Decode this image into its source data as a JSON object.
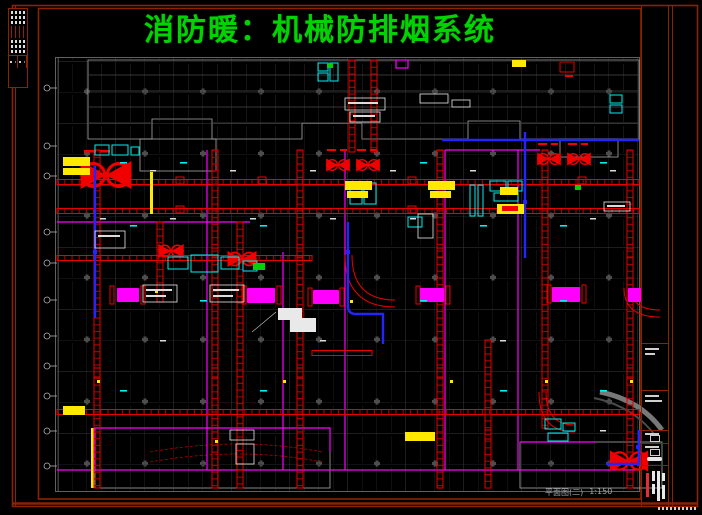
{
  "title": {
    "text": "消防暖：机械防排烟系统"
  },
  "drawing": {
    "caption": "平面图(二)",
    "scale": "1:150"
  },
  "palette": {
    "background": "#000000",
    "sheet_frame_red": "#8a2400",
    "title_green": "#00d400",
    "building_gray": "#8a8a8a",
    "duct_red": "#e80000",
    "boundary_magenta": "#ff00ff",
    "equipment_cyan": "#00f0f0",
    "highlight_yellow": "#ffe900",
    "pipe_blue": "#2424ff",
    "annotation_white": "#e9e9e9"
  },
  "symbols": {
    "fan_icon": "smoke-exhaust-fan",
    "smoke_vent": "smoke-vent-louver",
    "axis_bubble": "grid-axis-bubble"
  }
}
